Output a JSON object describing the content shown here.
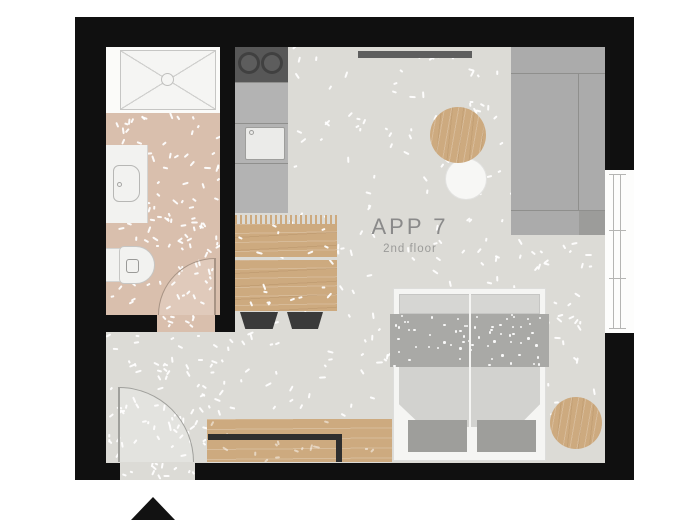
{
  "plan": {
    "title": "APP 7",
    "subtitle": "2nd floor"
  },
  "colors": {
    "wall": "#101010",
    "floor_main": "#dcdbd6",
    "floor_bath": "#d9bfad",
    "wood": "#cdaa7f",
    "counter": "#b3b3b3",
    "stove": "#575757",
    "sofa": "#ababab",
    "sofa_line": "#8f8f8d",
    "sofa_shade": "#9c9c9a",
    "bed_frame": "#f5f5f3",
    "bed_pillow": "#d6d6d3",
    "bed_dotted": "#a9a9a6",
    "bed_blanket": "#d2d2cf",
    "bed_mat": "#9e9e9b",
    "dark_furniture": "#3a3a3a",
    "bench_edge": "#2e2e2e",
    "fixture_white": "#f2f2f0",
    "label_text": "#8a8a8a",
    "sublabel_text": "#9b9b99",
    "wall_bar": "#5e5e5e",
    "triangle": "#121212"
  }
}
